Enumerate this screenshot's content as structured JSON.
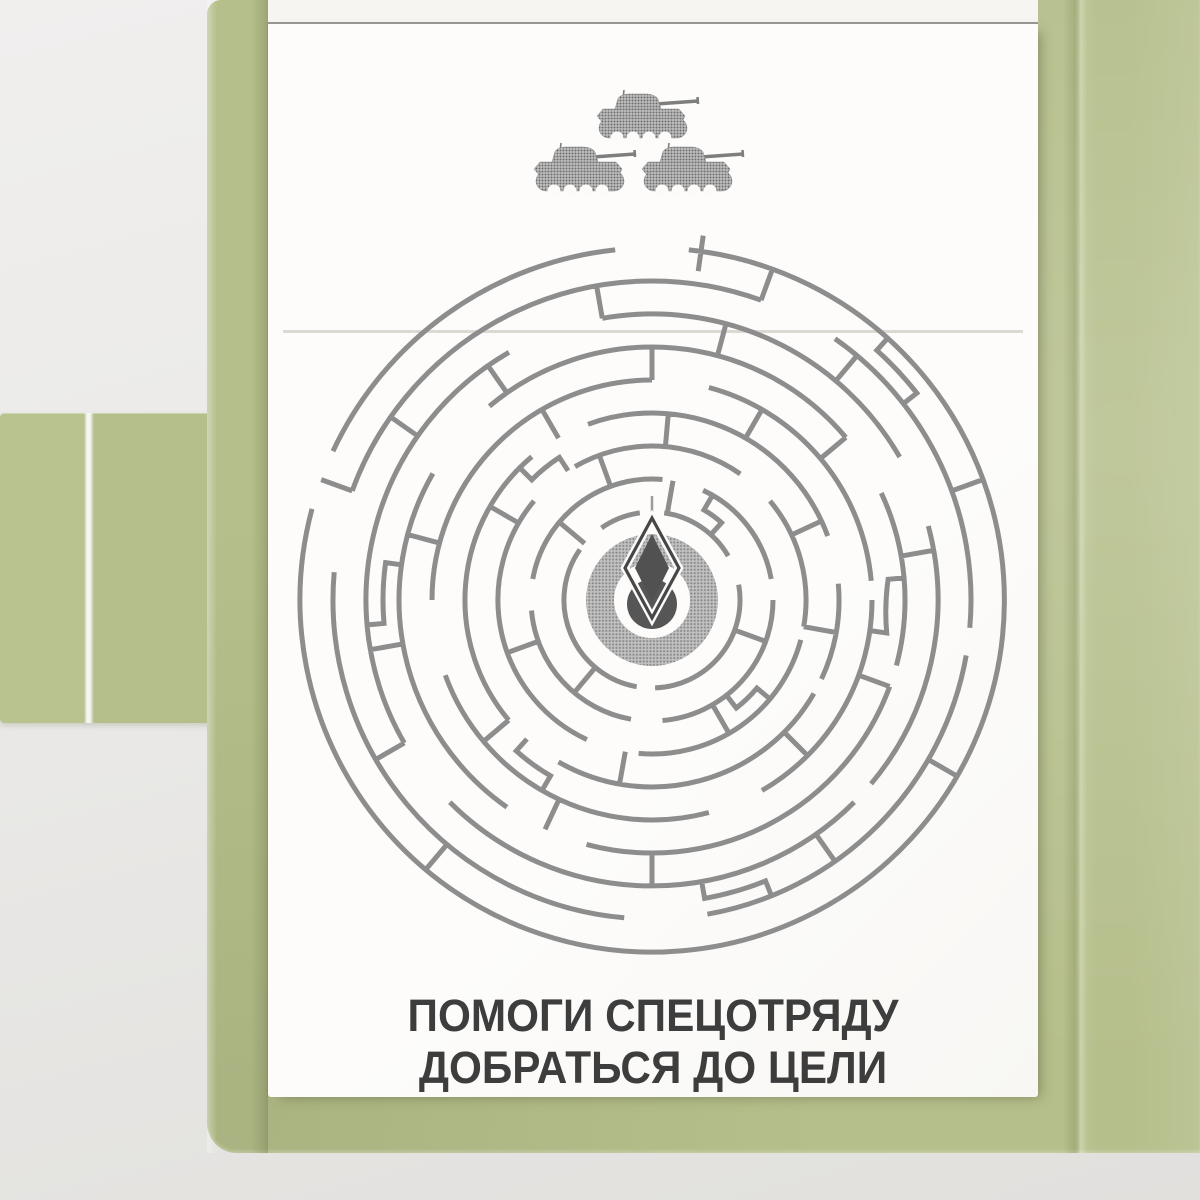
{
  "scene": {
    "description": "Opened olive-green cardboard notepad cover with a white puzzle page",
    "caption": {
      "line1": "ПОМОГИ СПЕЦОТРЯДУ",
      "line2": "ДОБРАТЬСЯ ДО ЦЕЛИ"
    }
  },
  "colors": {
    "cover_green": "#b5bf8b",
    "cover_green_light": "#b9c390",
    "paper": "#fcfbf9",
    "paper_back": "#f6f5f2",
    "hairline": "#97958f",
    "maze_line": "#8d8d8d",
    "ink": "#3d3d3d"
  },
  "tanks": {
    "count": 3,
    "formation": "triangle",
    "positions": [
      [
        330,
        66
      ],
      [
        267,
        119
      ],
      [
        375,
        119
      ]
    ]
  },
  "maze": {
    "cx": 384,
    "cy": 576,
    "rings": [
      {
        "r": 88,
        "arcs": [
          [
            100,
            215
          ],
          [
            235,
            262
          ],
          [
            278,
            330
          ],
          [
            350,
            448
          ]
        ]
      },
      {
        "r": 121,
        "arcs": [
          [
            0,
            85
          ],
          [
            100,
            175
          ],
          [
            190,
            275
          ],
          [
            295,
            350
          ]
        ]
      },
      {
        "r": 154,
        "arcs": [
          [
            15,
            95
          ],
          [
            115,
            220
          ],
          [
            240,
            305
          ],
          [
            320,
            370
          ]
        ]
      },
      {
        "r": 187,
        "arcs": [
          [
            30,
            120
          ],
          [
            140,
            230
          ],
          [
            250,
            340
          ],
          [
            355,
            385
          ]
        ]
      },
      {
        "r": 220,
        "arcs": [
          [
            0,
            60
          ],
          [
            75,
            160
          ],
          [
            180,
            270
          ],
          [
            285,
            355
          ]
        ]
      },
      {
        "r": 253,
        "arcs": [
          [
            20,
            105
          ],
          [
            125,
            210
          ],
          [
            230,
            320
          ],
          [
            335,
            375
          ]
        ]
      },
      {
        "r": 286,
        "arcs": [
          [
            45,
            135
          ],
          [
            150,
            240
          ],
          [
            260,
            330
          ],
          [
            345,
            400
          ]
        ]
      },
      {
        "r": 319,
        "arcs": [
          [
            10,
            80
          ],
          [
            95,
            185
          ],
          [
            200,
            290
          ],
          [
            305,
            365
          ]
        ]
      },
      {
        "r": 352,
        "arcs": [
          [
            276,
            445
          ],
          [
            85,
            195
          ],
          [
            205,
            264
          ]
        ]
      }
    ],
    "walls": [
      [
        290,
        319,
        352
      ],
      [
        340,
        319,
        352
      ],
      [
        30,
        319,
        352
      ],
      [
        130,
        319,
        352
      ],
      [
        200,
        319,
        352
      ],
      [
        260,
        286,
        319
      ],
      [
        310,
        286,
        319
      ],
      [
        55,
        286,
        319
      ],
      [
        150,
        286,
        319
      ],
      [
        215,
        286,
        319
      ],
      [
        285,
        253,
        286
      ],
      [
        350,
        253,
        286
      ],
      [
        90,
        253,
        286
      ],
      [
        170,
        253,
        286
      ],
      [
        235,
        253,
        286
      ],
      [
        270,
        220,
        253
      ],
      [
        20,
        220,
        253
      ],
      [
        115,
        220,
        253
      ],
      [
        195,
        220,
        253
      ],
      [
        320,
        220,
        253
      ],
      [
        300,
        187,
        220
      ],
      [
        45,
        187,
        220
      ],
      [
        140,
        187,
        220
      ],
      [
        240,
        187,
        220
      ],
      [
        275,
        154,
        187
      ],
      [
        10,
        154,
        187
      ],
      [
        100,
        154,
        187
      ],
      [
        210,
        154,
        187
      ],
      [
        335,
        154,
        187
      ],
      [
        250,
        121,
        154
      ],
      [
        60,
        121,
        154
      ],
      [
        160,
        121,
        154
      ],
      [
        280,
        88,
        121
      ],
      [
        130,
        88,
        121
      ],
      [
        20,
        88,
        121
      ],
      [
        220,
        88,
        121
      ],
      [
        278,
        332,
        368
      ]
    ],
    "jogs": [
      [
        312,
        352,
        336,
        322,
        319
      ],
      [
        68,
        319,
        303,
        80,
        286
      ],
      [
        175,
        286,
        269,
        188,
        253
      ],
      [
        355,
        253,
        237,
        8,
        220
      ],
      [
        120,
        220,
        203,
        132,
        187
      ],
      [
        225,
        187,
        170,
        237,
        154
      ],
      [
        40,
        154,
        137,
        52,
        121
      ],
      [
        300,
        121,
        104,
        312,
        88
      ]
    ],
    "needle": {
      "a": 270,
      "r1": 74,
      "r2": 104
    }
  }
}
